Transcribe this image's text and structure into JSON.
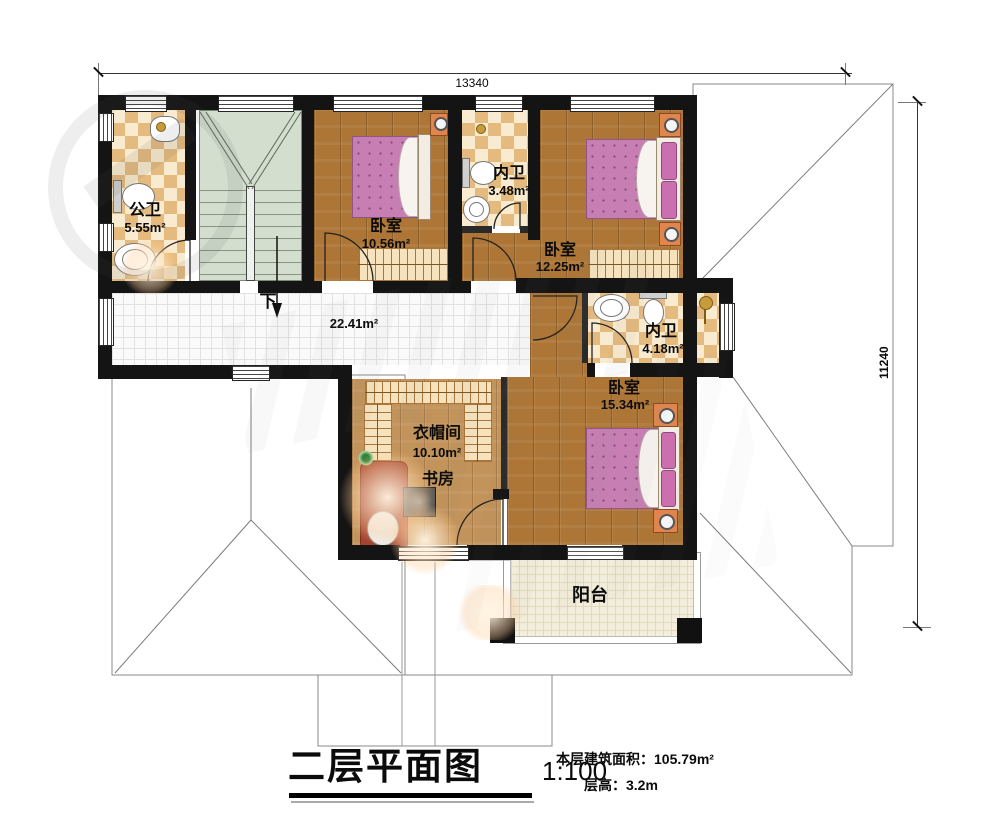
{
  "floorplan": {
    "title": "二层平面图",
    "scale": "1:100",
    "notes": {
      "area": "本层建筑面积：105.79m²",
      "floor_height": "层高：3.2m"
    },
    "dimensions": {
      "width_mm": "13340",
      "height_mm": "11240"
    },
    "rooms": {
      "public_bath": {
        "name": "公卫",
        "area": "5.55m²"
      },
      "bedroom_a": {
        "name": "卧室",
        "area": "10.56m²"
      },
      "inner_bath_a": {
        "name": "内卫",
        "area": "3.48m²"
      },
      "bedroom_b": {
        "name": "卧室",
        "area": "12.25m²"
      },
      "hallway": {
        "area": "22.41m²",
        "stairs_down": "下"
      },
      "inner_bath_b": {
        "name": "内卫",
        "area": "4.18m²"
      },
      "bedroom_c": {
        "name": "卧室",
        "area": "15.34m²"
      },
      "cloakroom": {
        "name": "衣帽间",
        "area": "10.10m²"
      },
      "study": {
        "name": "书房"
      },
      "balcony": {
        "name": "阳台"
      }
    },
    "colors": {
      "wall": "#141414",
      "wood_floor": "#ad7636",
      "tile_checker_dark": "#e4ba7e",
      "tile_checker_light": "#f8ebcf",
      "hallway_tile": "#fafafa",
      "stairs": "#d3decf",
      "balcony_tile": "#f3eedb",
      "bed": "#c77fb3",
      "nightstand": "#e0854e",
      "desk": "#a34331"
    }
  }
}
